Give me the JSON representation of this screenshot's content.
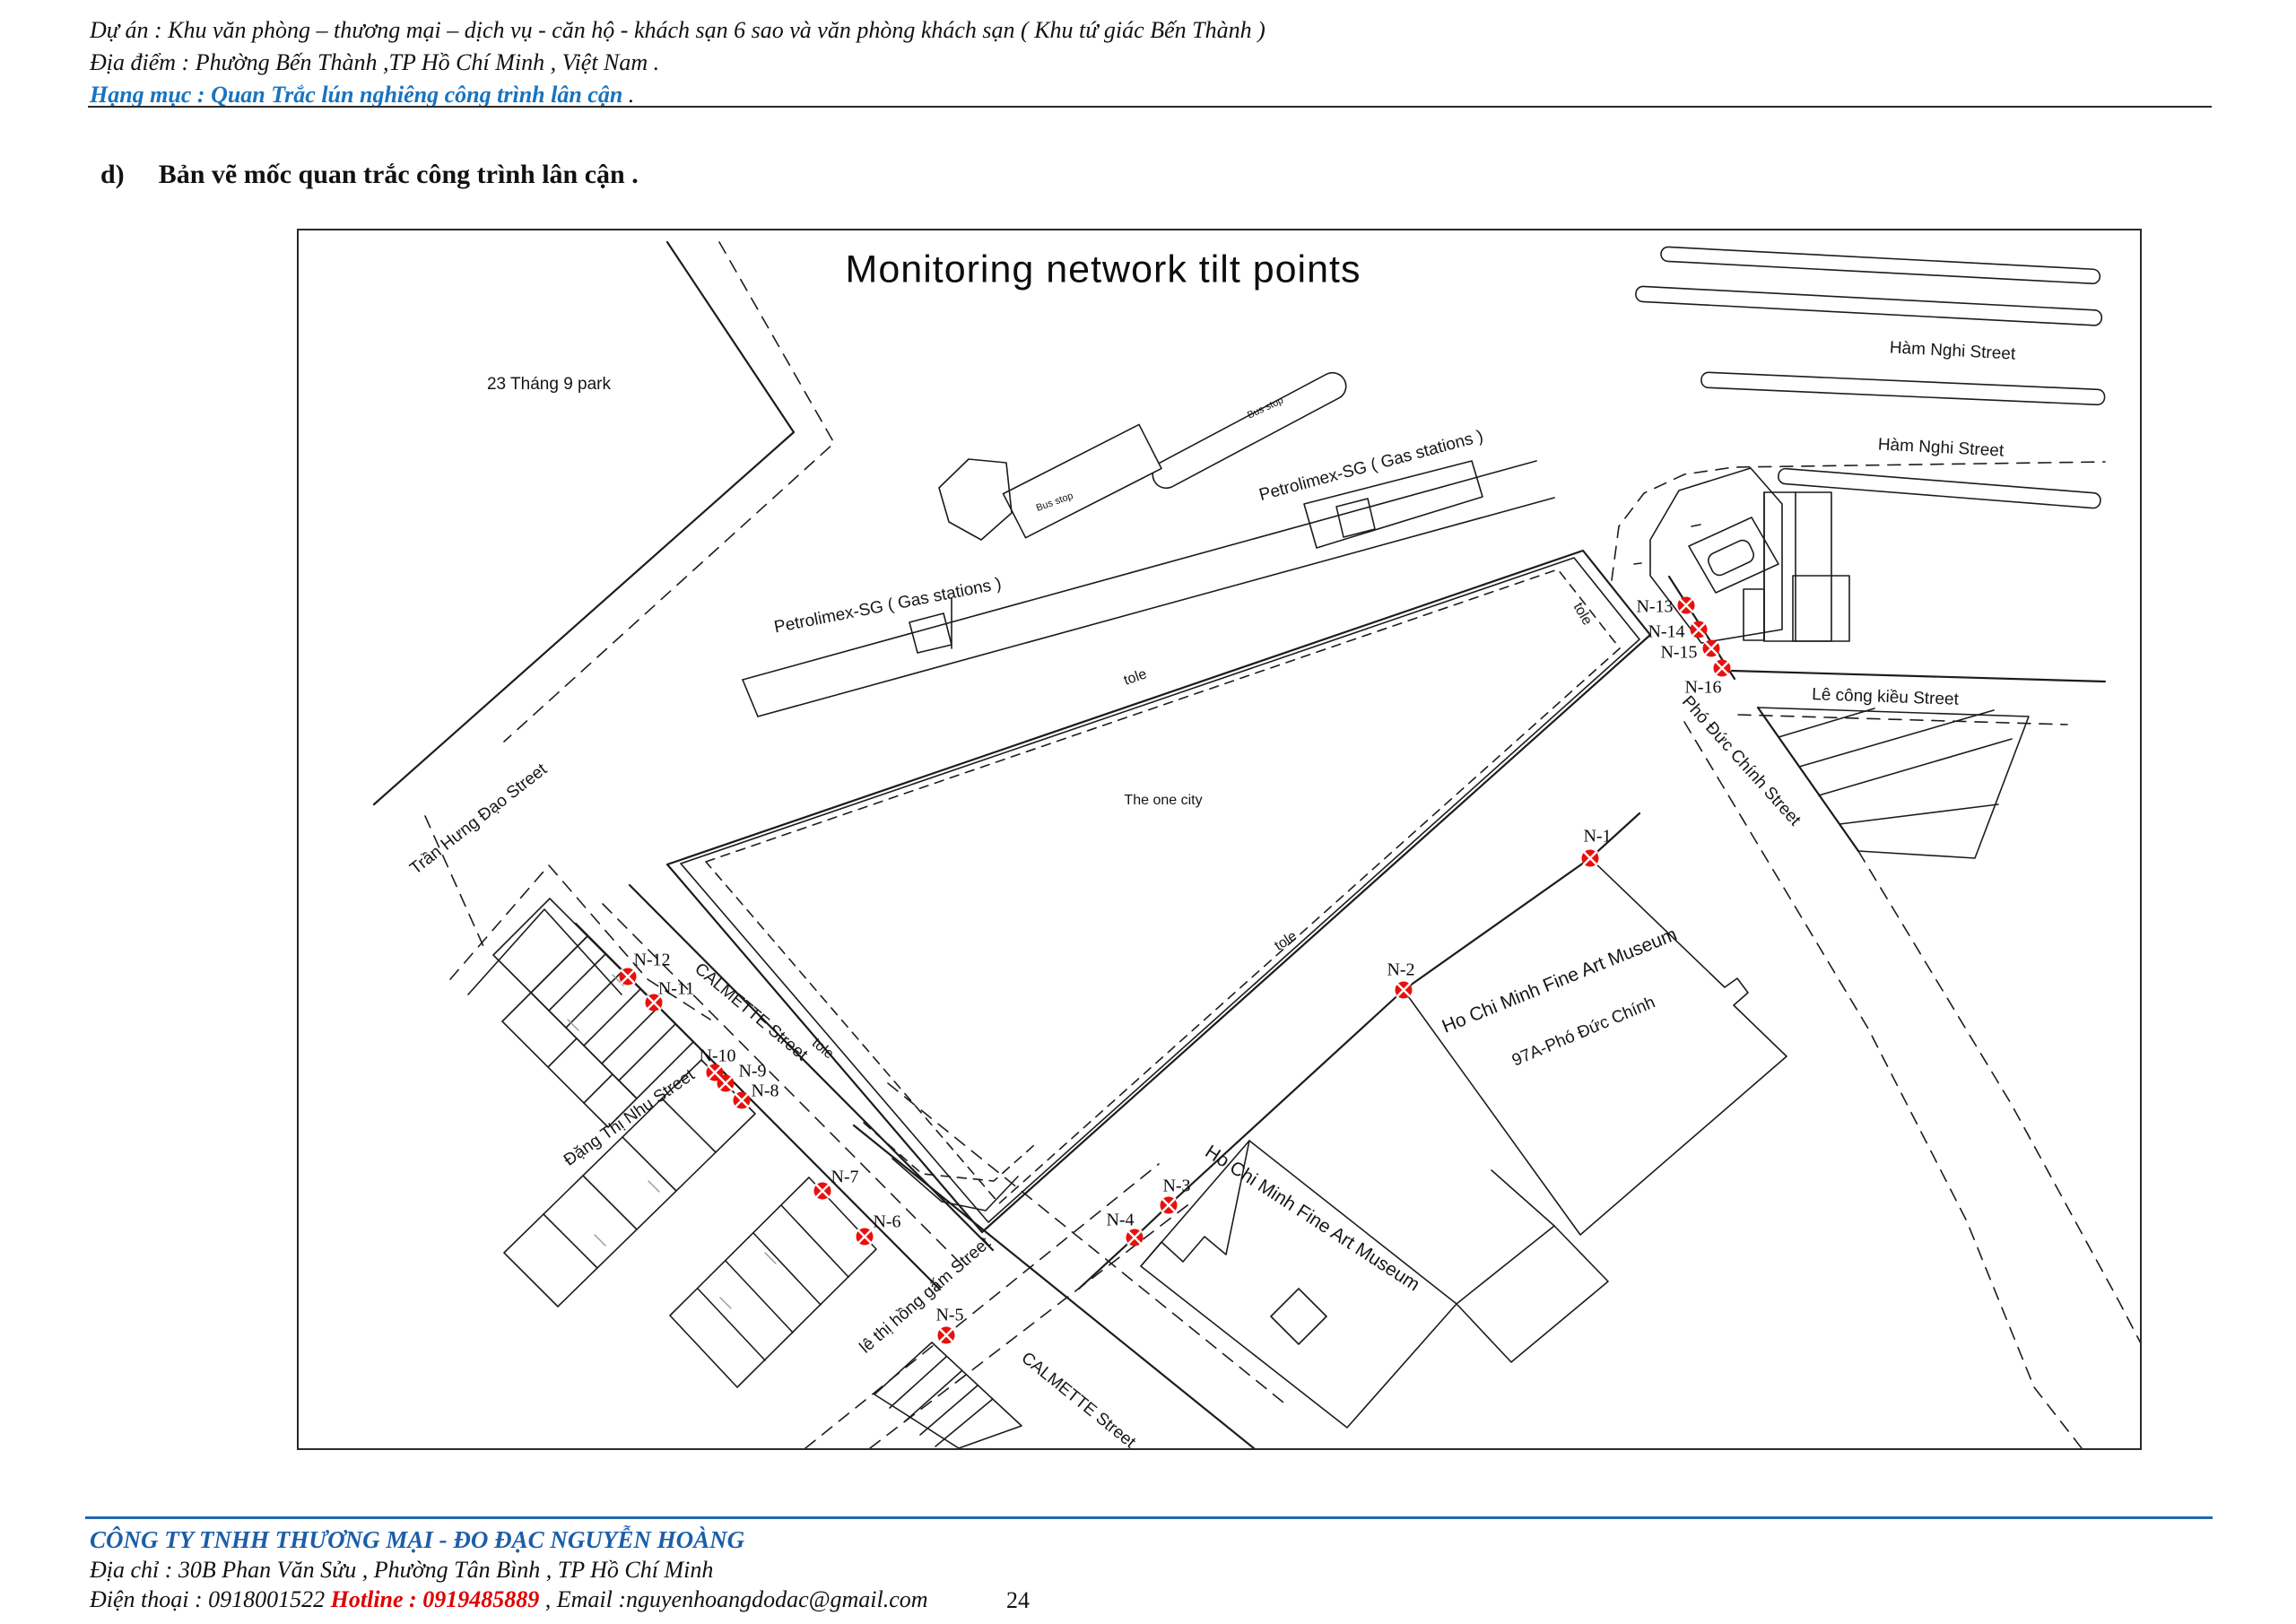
{
  "header": {
    "project": "Dự án  : Khu văn phòng – thương mại – dịch vụ - căn hộ - khách sạn 6 sao và văn phòng khách sạn ( Khu tứ giác Bến Thành )",
    "location": "Địa điểm : Phường Bến Thành ,TP Hồ Chí Minh , Việt Nam  .",
    "category": "Hạng mục  : Quan Trắc lún nghiêng công trình lân cận",
    "category_suffix": "   ."
  },
  "section": {
    "index": "d)",
    "title": "Bản vẽ mốc quan trắc công trình lân cận ."
  },
  "map": {
    "title": "Monitoring network tilt points",
    "labels": {
      "ham_nghi_1": "Hàm Nghi Street",
      "ham_nghi_2": "Hàm Nghi Street",
      "le_cong_kieu": "Lê công kiều Street",
      "pho_duc_chinh": "Phó Đức Chính Street",
      "tran_hung_dao": "Trần Hưng Đạo Street",
      "calmette_upper": "CALMETTE Street",
      "calmette_lower": "CALMETTE Street",
      "dang_thi_nhu": "Đặng Thị Nhu Street",
      "le_thi_hong_gam": "lê thị hồng gấm Street",
      "park": "23 Tháng 9 park",
      "the_one_city": "The one city",
      "petrolimex_1": "Petrolimex-SG ( Gas stations )",
      "petrolimex_2": "Petrolimex-SG ( Gas stations )",
      "bus_stop_1": "Bus stop",
      "bus_stop_2": "Bus stop",
      "museum_1": "Ho Chi Minh Fine Art Museum",
      "museum_2": "Ho Chi Minh Fine Art Museum",
      "address_97a": "97A-Phó Đức Chính",
      "tole_1": "tole",
      "tole_2": "tole",
      "tole_3": "tole",
      "tole_4": "tole"
    },
    "points": {
      "n1": "N-1",
      "n2": "N-2",
      "n3": "N-3",
      "n4": "N-4",
      "n5": "N-5",
      "n6": "N-6",
      "n7": "N-7",
      "n8": "N-8",
      "n9": "N-9",
      "n10": "N-10",
      "n11": "N-11",
      "n12": "N-12",
      "n13": "N-13",
      "n14": "N-14",
      "n15": "N-15",
      "n16": "N-16"
    },
    "marker_color": "#e8100c"
  },
  "footer": {
    "company": "CÔNG TY TNHH THƯƠNG MẠI - ĐO ĐẠC NGUYỄN HOÀNG",
    "address": "Địa chỉ : 30B Phan Văn Sửu , Phường Tân Bình  , TP Hồ Chí Minh",
    "phone": "Điện thoại : 0918001522",
    "hotline": "  Hotline :  0919485889",
    "email": " , Email :nguyenhoangdodac@gmail.com",
    "page_number": "24"
  }
}
